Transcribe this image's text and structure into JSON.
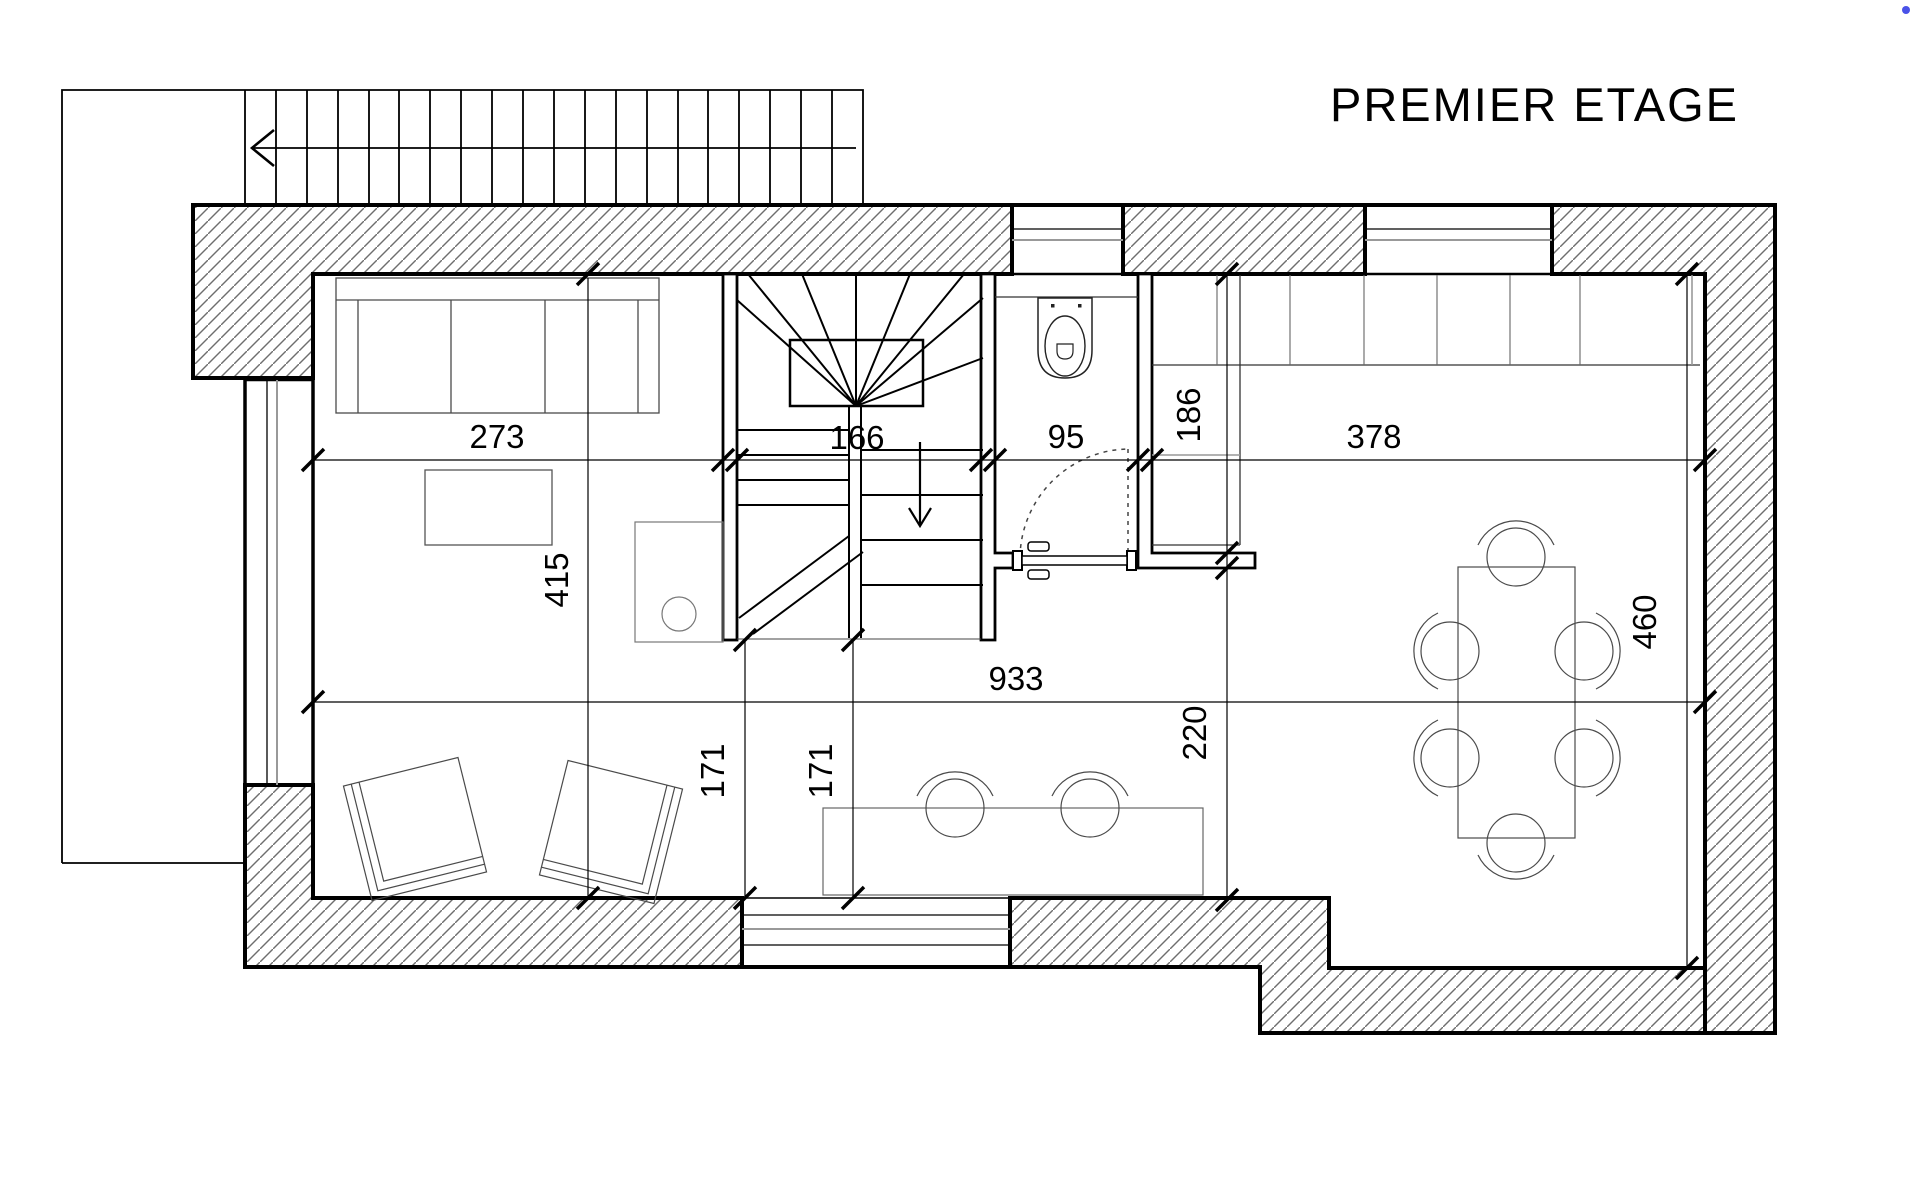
{
  "title": "PREMIER ETAGE",
  "floor_plan": {
    "dims": {
      "living_width": "273",
      "stair_width": "166",
      "wc_width": "95",
      "kitchen_width": "378",
      "kitchen_depth": "186",
      "living_depth": "415",
      "dining_depth": "460",
      "overall_width": "933",
      "stair_clearance_left": "171",
      "stair_clearance_right": "171",
      "passage_depth": "220"
    },
    "colors": {
      "line": "#000000",
      "hatch": "#6e6e6e",
      "furniture": "#4a4a4a",
      "background": "#ffffff",
      "cursor_dot": "#4a52e8"
    }
  }
}
